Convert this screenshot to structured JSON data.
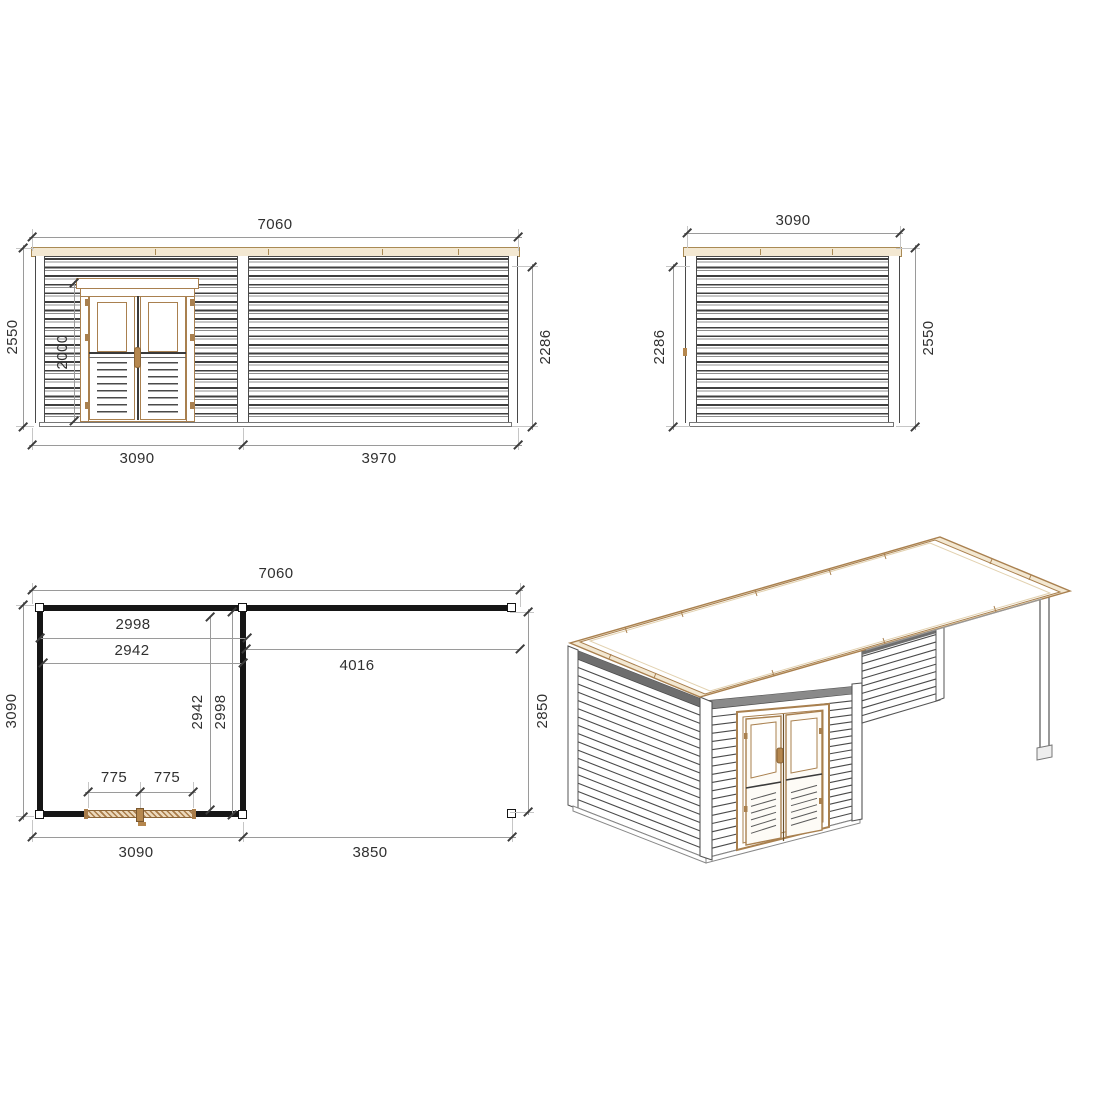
{
  "drawing": {
    "type": "garden-cabin technical drawing, three orthographic views + isometric view",
    "units": "mm"
  },
  "front_elevation": {
    "total_width": "7060",
    "total_height_left": "2550",
    "door_height": "2000",
    "wall_height_right": "2286",
    "module_left_width": "3090",
    "module_right_width": "3970"
  },
  "side_elevation": {
    "width": "3090",
    "wall_height_left": "2286",
    "total_height_right": "2550"
  },
  "floor_plan": {
    "total_width": "7060",
    "room_inner_width": "2998",
    "room_clear_width": "2942",
    "terrace_inner_width": "4016",
    "depth_left": "3090",
    "room_clear_depth": "2942",
    "room_inner_depth": "2998",
    "terrace_depth_right": "2850",
    "door_leaf_left": "775",
    "door_leaf_right": "775",
    "room_outer_width": "3090",
    "terrace_outer_width": "3850"
  },
  "colors": {
    "wood_accent": "#a9804f",
    "roof_fill": "#f3e8d2",
    "slat_dark": "#3f3f3f",
    "dimension_line": "#9a9a9a",
    "text": "#303030"
  }
}
